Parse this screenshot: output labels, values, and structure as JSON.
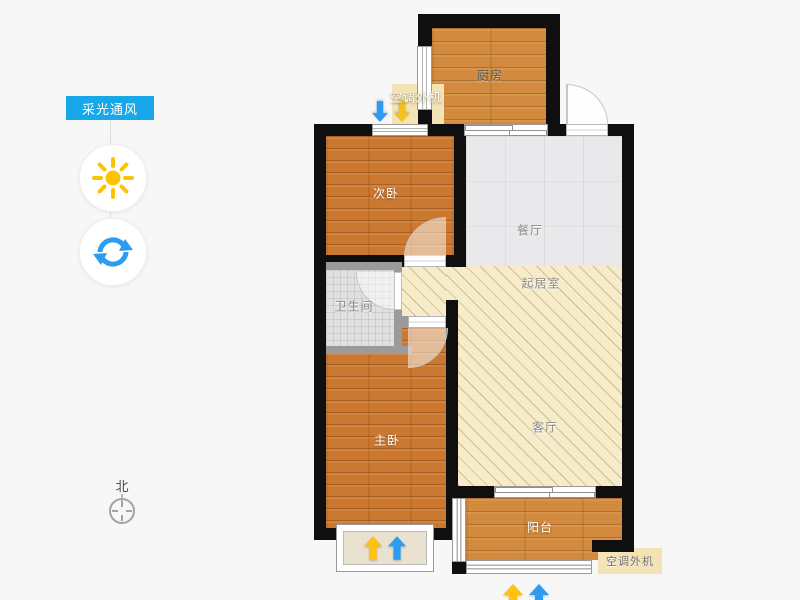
{
  "sidebar": {
    "lighting_button": "采光通风"
  },
  "compass": {
    "north_label": "北"
  },
  "plan": {
    "rooms": {
      "kitchen": "厨房",
      "bedroom2": "次卧",
      "dining": "餐厅",
      "hall": "起居室",
      "bathroom": "卫生间",
      "master": "主卧",
      "living": "客厅",
      "balcony": "阳台"
    },
    "ac_top": "空调外机",
    "ac_bottom": "空调外机"
  },
  "colors": {
    "accent_blue": "#18a7e8",
    "sun_yellow": "#fcc400",
    "rotate_blue": "#2a9df0",
    "arrow_blue": "#2d9cf0",
    "arrow_yellow": "#ffc20e",
    "wall": "#0f0f0f",
    "wood_floor": "#d18a3e",
    "hatch_floor": "#f6ecca",
    "tile_floor": "#e9e9ea",
    "ac_platform": "#f3e3b5"
  }
}
